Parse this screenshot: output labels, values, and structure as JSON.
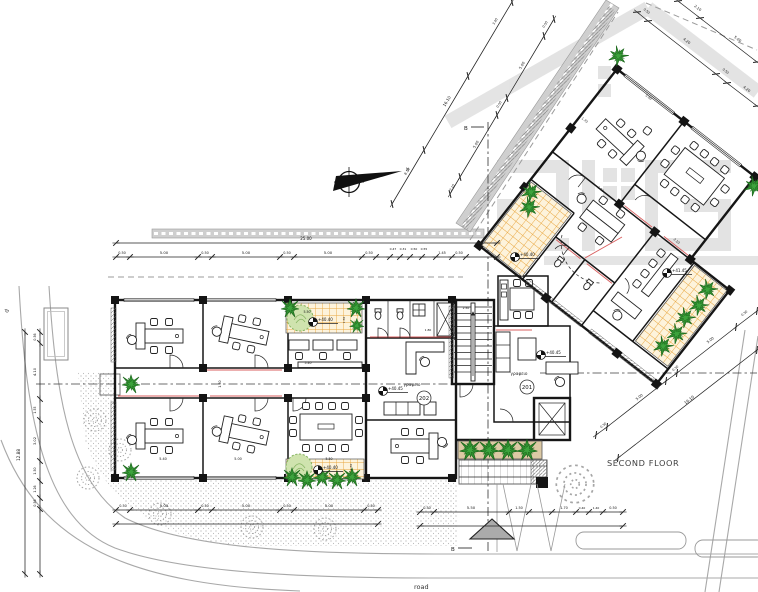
{
  "drawing": {
    "floor_label": "SECOND FLOOR",
    "road_label": "road",
    "left_road_label": "d",
    "section_marker_top": "B",
    "section_marker_bottom": "B",
    "north_marker": "N"
  },
  "rooms": {
    "office_201": {
      "number": "201",
      "name": "γραφειο"
    },
    "office_202": {
      "number": "202",
      "name": "γραφειο"
    }
  },
  "levels": [
    {
      "value": "+40.40"
    },
    {
      "value": "+40.40"
    },
    {
      "value": "+40.45"
    },
    {
      "value": "+40.45"
    },
    {
      "value": "+40.40"
    },
    {
      "value": "+41.45"
    }
  ],
  "colors": {
    "accent_red": "#d95f5f",
    "tile_line": "#e8a53c",
    "tile_bg": "#fdf3dc",
    "plant_green": "#2f8f2f",
    "tree_fill": "#cfe3ae",
    "road_gray": "#cfcfcf",
    "watermark_gray": "#c6c6c6"
  },
  "annotations": [
    {
      "t": "25.00",
      "x": 306,
      "y": 240,
      "s": 4
    },
    {
      "t": "0.50",
      "x": 122,
      "y": 254,
      "s": 3.4
    },
    {
      "t": "5.00",
      "x": 164,
      "y": 254,
      "s": 3.8
    },
    {
      "t": "0.50",
      "x": 205,
      "y": 254,
      "s": 3.4
    },
    {
      "t": "5.00",
      "x": 246,
      "y": 254,
      "s": 3.8
    },
    {
      "t": "0.50",
      "x": 287,
      "y": 254,
      "s": 3.4
    },
    {
      "t": "5.00",
      "x": 328,
      "y": 254,
      "s": 3.8
    },
    {
      "t": "0.50",
      "x": 369,
      "y": 254,
      "s": 3.4
    },
    {
      "t": "0.47",
      "x": 393,
      "y": 250,
      "s": 3
    },
    {
      "t": "0.31",
      "x": 403,
      "y": 250,
      "s": 3
    },
    {
      "t": "0.50",
      "x": 414,
      "y": 250,
      "s": 3
    },
    {
      "t": "0.55",
      "x": 424,
      "y": 250,
      "s": 3
    },
    {
      "t": "1.45",
      "x": 442,
      "y": 254,
      "s": 3.4
    },
    {
      "t": "0.50",
      "x": 459,
      "y": 254,
      "s": 3.4
    },
    {
      "t": "0.50",
      "x": 123,
      "y": 507,
      "s": 3.4
    },
    {
      "t": "5.00",
      "x": 164,
      "y": 507,
      "s": 3.8
    },
    {
      "t": "0.50",
      "x": 205,
      "y": 507,
      "s": 3.4
    },
    {
      "t": "5.00",
      "x": 246,
      "y": 507,
      "s": 3.8
    },
    {
      "t": "0.50",
      "x": 287,
      "y": 507,
      "s": 3.4
    },
    {
      "t": "5.00",
      "x": 329,
      "y": 507,
      "s": 3.8
    },
    {
      "t": "0.50",
      "x": 371,
      "y": 507,
      "s": 3.4
    },
    {
      "t": "0.50",
      "x": 427,
      "y": 509,
      "s": 3.4
    },
    {
      "t": "5.50",
      "x": 471,
      "y": 509,
      "s": 3.8
    },
    {
      "t": "1.50",
      "x": 519,
      "y": 509,
      "s": 3.4
    },
    {
      "t": "1.70",
      "x": 564,
      "y": 509,
      "s": 3.4
    },
    {
      "t": "0.40",
      "x": 582,
      "y": 509,
      "s": 3
    },
    {
      "t": "1.40",
      "x": 596,
      "y": 509,
      "s": 3
    },
    {
      "t": "0.50",
      "x": 613,
      "y": 509,
      "s": 3.4
    },
    {
      "t": "12.88",
      "x": 20,
      "y": 455,
      "r": -90,
      "s": 4.2
    },
    {
      "t": "0.56",
      "x": 36,
      "y": 337,
      "r": -90,
      "s": 3.2
    },
    {
      "t": "4.10",
      "x": 36,
      "y": 372,
      "r": -90,
      "s": 3.6
    },
    {
      "t": "1.55",
      "x": 36,
      "y": 410,
      "r": -90,
      "s": 3.2
    },
    {
      "t": "3.02",
      "x": 36,
      "y": 441,
      "r": -90,
      "s": 3.6
    },
    {
      "t": "1.50",
      "x": 36,
      "y": 471,
      "r": -90,
      "s": 3.2
    },
    {
      "t": "1.26",
      "x": 36,
      "y": 489,
      "r": -90,
      "s": 3.2
    },
    {
      "t": "0.56",
      "x": 36,
      "y": 503,
      "r": -90,
      "s": 3.2
    },
    {
      "t": "0.50",
      "x": 646,
      "y": 12,
      "r": 38,
      "s": 3.2
    },
    {
      "t": "4.20",
      "x": 686,
      "y": 42,
      "r": 38,
      "s": 3.6
    },
    {
      "t": "0.50",
      "x": 725,
      "y": 72,
      "r": 38,
      "s": 3.2
    },
    {
      "t": "4.20",
      "x": 746,
      "y": 90,
      "r": 38,
      "s": 3.6
    },
    {
      "t": "2.10",
      "x": 697,
      "y": 9,
      "r": 38,
      "s": 3.6
    },
    {
      "t": "5.00",
      "x": 737,
      "y": 40,
      "r": 38,
      "s": 3.6
    },
    {
      "t": "0.50",
      "x": 546,
      "y": 25,
      "r": -59,
      "s": 3.2
    },
    {
      "t": "5.00",
      "x": 523,
      "y": 66,
      "r": -59,
      "s": 3.6
    },
    {
      "t": "0.50",
      "x": 500,
      "y": 105,
      "r": -59,
      "s": 3.2
    },
    {
      "t": "5.00",
      "x": 477,
      "y": 145,
      "r": -59,
      "s": 3.6
    },
    {
      "t": "2.10",
      "x": 453,
      "y": 188,
      "r": -59,
      "s": 3.2
    },
    {
      "t": "3.40",
      "x": 496,
      "y": 22,
      "r": -59,
      "s": 3.2
    },
    {
      "t": "16.10",
      "x": 448,
      "y": 102,
      "r": -59,
      "s": 4
    },
    {
      "t": "8.10",
      "x": 408,
      "y": 172,
      "r": -59,
      "s": 3.4
    },
    {
      "t": "0.50",
      "x": 604,
      "y": 426,
      "r": -38,
      "s": 3.2
    },
    {
      "t": "5.00",
      "x": 640,
      "y": 398,
      "r": -38,
      "s": 3.6
    },
    {
      "t": "0.50",
      "x": 676,
      "y": 369,
      "r": -38,
      "s": 3.2
    },
    {
      "t": "5.00",
      "x": 711,
      "y": 341,
      "r": -38,
      "s": 3.6
    },
    {
      "t": "0.50",
      "x": 745,
      "y": 314,
      "r": -38,
      "s": 3.2
    },
    {
      "t": "16.10",
      "x": 690,
      "y": 401,
      "r": -38,
      "s": 4
    },
    {
      "t": "5.40",
      "x": 163,
      "y": 460,
      "s": 3.4
    },
    {
      "t": "5.00",
      "x": 238,
      "y": 460,
      "s": 3.4
    },
    {
      "t": "5.40",
      "x": 308,
      "y": 364,
      "s": 3.2
    },
    {
      "t": "1.50",
      "x": 221,
      "y": 384,
      "r": -90,
      "s": 3.2
    },
    {
      "t": "5.50",
      "x": 307,
      "y": 313,
      "s": 3.2,
      "c": "#8a3030"
    },
    {
      "t": "1.50",
      "x": 345,
      "y": 320,
      "r": -90,
      "s": 3
    },
    {
      "t": "5.50",
      "x": 329,
      "y": 460,
      "s": 3.2,
      "c": "#8a3030"
    },
    {
      "t": "1.50",
      "x": 352,
      "y": 467,
      "r": -90,
      "s": 3
    },
    {
      "t": "1.80",
      "x": 428,
      "y": 331,
      "s": 3
    },
    {
      "t": "2.50",
      "x": 466,
      "y": 309,
      "s": 3
    },
    {
      "t": "1.70",
      "x": 584,
      "y": 121,
      "r": 38,
      "s": 3.2
    },
    {
      "t": "5.00",
      "x": 648,
      "y": 98,
      "r": 38,
      "s": 3.2
    },
    {
      "t": "1.50",
      "x": 600,
      "y": 190,
      "r": 38,
      "s": 3.2
    },
    {
      "t": "2.10",
      "x": 676,
      "y": 242,
      "r": 38,
      "s": 3.2
    }
  ]
}
